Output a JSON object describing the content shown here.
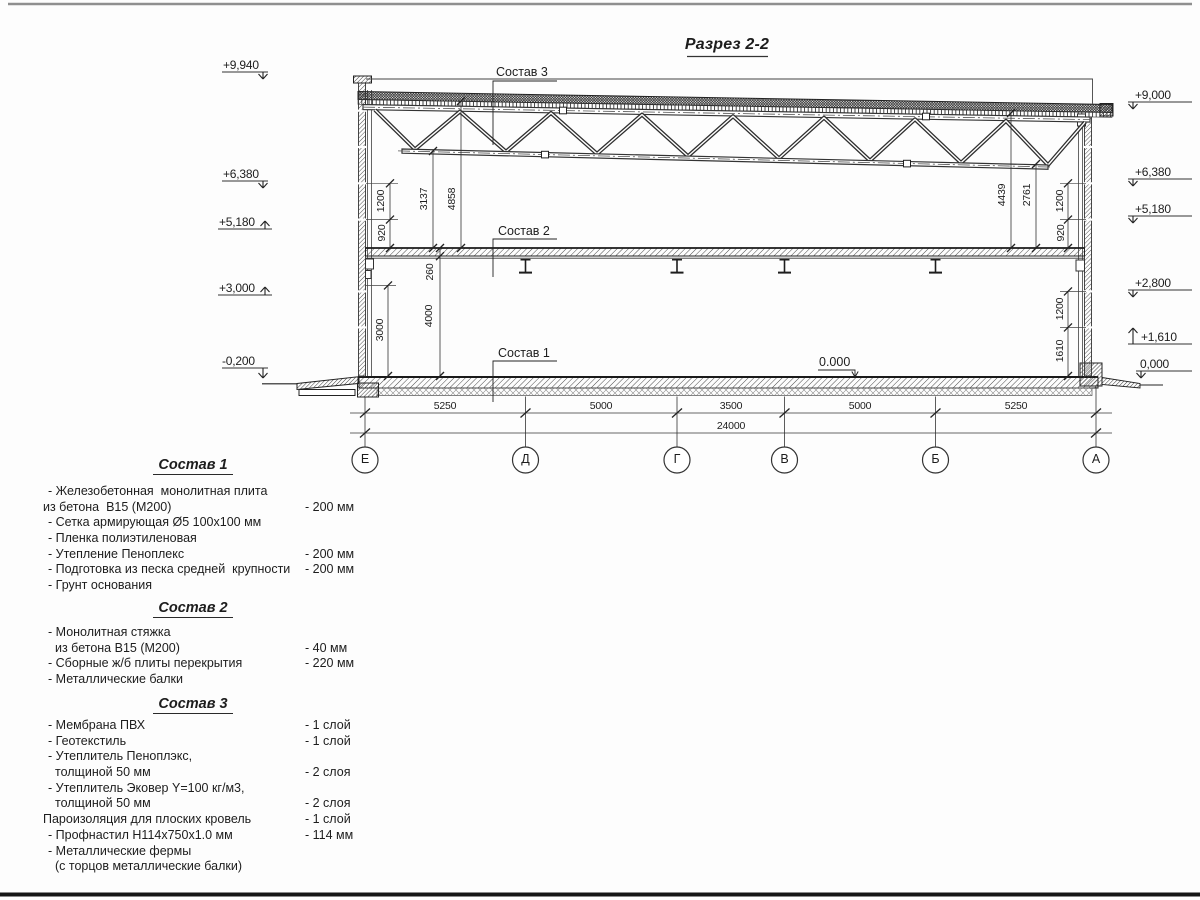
{
  "title": {
    "text": "Разрез 2-2"
  },
  "axes": {
    "letters": [
      "Е",
      "Д",
      "Г",
      "В",
      "Б",
      "А"
    ]
  },
  "annotations": [
    {
      "name": "axis-letter-e",
      "cls": "axl",
      "x": 365,
      "y": 452,
      "t": "Е"
    },
    {
      "name": "axis-letter-d",
      "cls": "axl",
      "x": 525.5,
      "y": 452,
      "t": "Д"
    },
    {
      "name": "axis-letter-g",
      "cls": "axl",
      "x": 677,
      "y": 452,
      "t": "Г"
    },
    {
      "name": "axis-letter-v",
      "cls": "axl",
      "x": 784.5,
      "y": 452,
      "t": "В"
    },
    {
      "name": "axis-letter-b",
      "cls": "axl",
      "x": 935.5,
      "y": 452,
      "t": "Б"
    },
    {
      "name": "axis-letter-a",
      "cls": "axl",
      "x": 1096,
      "y": 452,
      "t": "А"
    },
    {
      "name": "dim-span-e-d",
      "cls": "dim",
      "x": 445,
      "y": 400,
      "t": "5250"
    },
    {
      "name": "dim-span-d-g",
      "cls": "dim",
      "x": 601,
      "y": 400,
      "t": "5000"
    },
    {
      "name": "dim-span-g-v",
      "cls": "dim",
      "x": 731,
      "y": 400,
      "t": "3500"
    },
    {
      "name": "dim-span-v-b",
      "cls": "dim",
      "x": 860,
      "y": 400,
      "t": "5000"
    },
    {
      "name": "dim-span-b-a",
      "cls": "dim",
      "x": 1016,
      "y": 400,
      "t": "5250"
    },
    {
      "name": "dim-total",
      "cls": "dim",
      "x": 731,
      "y": 420,
      "t": "24000"
    },
    {
      "name": "dim-left-1200",
      "cls": "dimv",
      "x": 381,
      "y": 201,
      "t": "1200"
    },
    {
      "name": "dim-left-920",
      "cls": "dimv",
      "x": 382,
      "y": 233,
      "t": "920"
    },
    {
      "name": "dim-3137",
      "cls": "dimv",
      "x": 424,
      "y": 199,
      "t": "3137"
    },
    {
      "name": "dim-4858",
      "cls": "dimv",
      "x": 452,
      "y": 199,
      "t": "4858"
    },
    {
      "name": "dim-260",
      "cls": "dimv",
      "x": 430,
      "y": 272,
      "t": "260"
    },
    {
      "name": "dim-4000",
      "cls": "dimv",
      "x": 429,
      "y": 316,
      "t": "4000"
    },
    {
      "name": "dim-3000",
      "cls": "dimv",
      "x": 380,
      "y": 330,
      "t": "3000"
    },
    {
      "name": "dim-4439",
      "cls": "dimv",
      "x": 1002,
      "y": 195,
      "t": "4439"
    },
    {
      "name": "dim-2761",
      "cls": "dimv",
      "x": 1027,
      "y": 195,
      "t": "2761"
    },
    {
      "name": "dim-right-1200-top",
      "cls": "dimv",
      "x": 1060,
      "y": 201,
      "t": "1200"
    },
    {
      "name": "dim-right-920",
      "cls": "dimv",
      "x": 1061,
      "y": 233,
      "t": "920"
    },
    {
      "name": "dim-right-1200-low",
      "cls": "dimv",
      "x": 1060,
      "y": 309,
      "t": "1200"
    },
    {
      "name": "dim-right-1610",
      "cls": "dimv",
      "x": 1060,
      "y": 351,
      "t": "1610"
    },
    {
      "name": "elev-left-9940",
      "cls": "elev",
      "x": 223,
      "y": 58,
      "t": "+9,940"
    },
    {
      "name": "elev-left-6380",
      "cls": "elev",
      "x": 223,
      "y": 167,
      "t": "+6,380"
    },
    {
      "name": "elev-left-5180",
      "cls": "elev",
      "x": 219,
      "y": 215,
      "t": "+5,180"
    },
    {
      "name": "elev-left-3000",
      "cls": "elev",
      "x": 219,
      "y": 281,
      "t": "+3,000"
    },
    {
      "name": "elev-left-0200",
      "cls": "elev",
      "x": 222,
      "y": 354,
      "t": "-0,200"
    },
    {
      "name": "elev-right-9000",
      "cls": "elev",
      "x": 1135,
      "y": 88,
      "t": "+9,000"
    },
    {
      "name": "elev-right-6380",
      "cls": "elev",
      "x": 1135,
      "y": 165,
      "t": "+6,380"
    },
    {
      "name": "elev-right-5180",
      "cls": "elev",
      "x": 1135,
      "y": 202,
      "t": "+5,180"
    },
    {
      "name": "elev-right-2800",
      "cls": "elev",
      "x": 1135,
      "y": 276,
      "t": "+2,800"
    },
    {
      "name": "elev-right-1610",
      "cls": "elev",
      "x": 1141,
      "y": 330,
      "t": "+1,610"
    },
    {
      "name": "elev-right-0000",
      "cls": "elev",
      "x": 1140,
      "y": 357,
      "t": "0,000"
    },
    {
      "name": "callout-sostav-3",
      "cls": "callout",
      "x": 496,
      "y": 65,
      "t": "Состав 3"
    },
    {
      "name": "callout-sostav-2",
      "cls": "callout",
      "x": 498,
      "y": 224,
      "t": "Состав 2"
    },
    {
      "name": "callout-sostav-1",
      "cls": "callout",
      "x": 498,
      "y": 346,
      "t": "Состав 1"
    },
    {
      "name": "level-zero-inline",
      "cls": "callout",
      "x": 819,
      "y": 355,
      "t": "0.000"
    }
  ],
  "materials": [
    {
      "heading": "Состав 1",
      "top": 456,
      "items_top": 484,
      "items": [
        {
          "t": "- Железобетонная  монолитная плита"
        },
        {
          "t": "из бетона  В15 (М200)",
          "v": "- 200 мм",
          "ind": 1
        },
        {
          "t": "- Сетка армирующая Ø5 100х100 мм"
        },
        {
          "t": "- Пленка полиэтиленовая"
        },
        {
          "t": "- Утепление Пеноплекс",
          "v": "- 200 мм"
        },
        {
          "t": "- Подготовка из песка средней  крупности",
          "v": "- 200 мм"
        },
        {
          "t": "- Грунт основания"
        }
      ]
    },
    {
      "heading": "Состав 2",
      "top": 599,
      "items_top": 625,
      "items": [
        {
          "t": "- Монолитная стяжка"
        },
        {
          "t": "из бетона В15 (М200)",
          "v": "- 40 мм",
          "ind": 2
        },
        {
          "t": "- Сборные ж/б плиты перекрытия",
          "v": "- 220 мм"
        },
        {
          "t": "- Металлические балки"
        }
      ]
    },
    {
      "heading": "Состав 3",
      "top": 695,
      "items_top": 718,
      "items": [
        {
          "t": "- Мембрана ПВХ",
          "v": "- 1 слой"
        },
        {
          "t": "- Геотекстиль",
          "v": "- 1 слой"
        },
        {
          "t": "- Утеплитель Пеноплэкс,"
        },
        {
          "t": "толщиной 50 мм",
          "v": "- 2 слоя",
          "ind": 2
        },
        {
          "t": "- Утеплитель Эковер Y=100 кг/м3,"
        },
        {
          "t": "толщиной 50 мм",
          "v": "- 2 слоя",
          "ind": 2
        },
        {
          "t": "Пароизоляция для плоских кровель",
          "v": "- 1 слой",
          "ind": 1
        },
        {
          "t": "- Профнастил Н114х750х1.0 мм",
          "v": "- 114 мм"
        },
        {
          "t": "- Металлические фермы"
        },
        {
          "t": "(с торцов металлические балки)",
          "ind": 2
        }
      ]
    }
  ]
}
